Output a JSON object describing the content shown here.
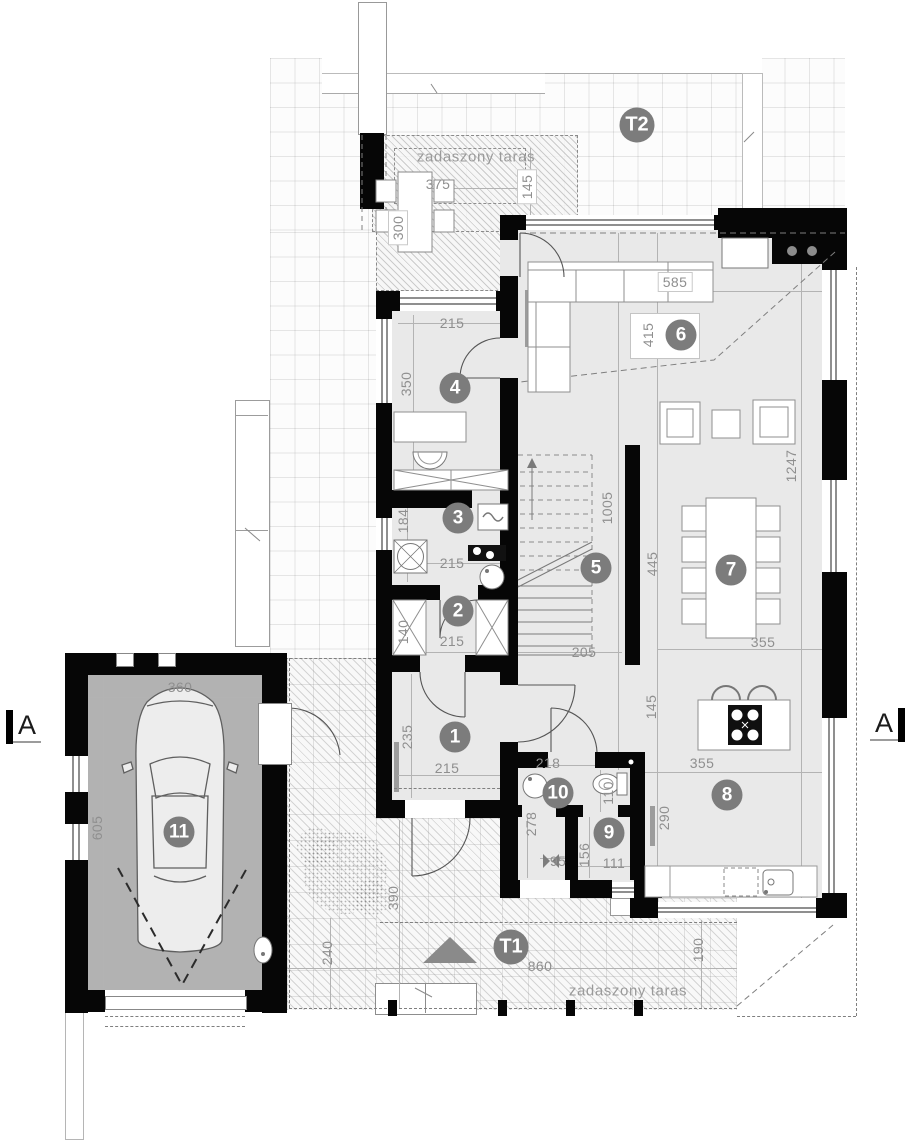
{
  "markers": {
    "t1": "T1",
    "t2": "T2",
    "section_a_left": "A",
    "section_a_right": "A"
  },
  "terrace_top": {
    "name": "zadaszony taras",
    "dims": {
      "width": "375",
      "depth": "145",
      "side": "300"
    }
  },
  "terrace_bottom": {
    "name": "zadaszony taras",
    "dims": {
      "width": "860",
      "left": "240",
      "walk": "390",
      "right": "190"
    }
  },
  "rooms": [
    {
      "no": "1",
      "dims": [
        "235",
        "215"
      ]
    },
    {
      "no": "2",
      "dims": [
        "140",
        "215"
      ]
    },
    {
      "no": "3",
      "dims": [
        "184",
        "215"
      ]
    },
    {
      "no": "4",
      "dims": [
        "215",
        "350"
      ]
    },
    {
      "no": "5",
      "dims": [
        "1005",
        "205"
      ]
    },
    {
      "no": "6",
      "dims": [
        "585",
        "415"
      ]
    },
    {
      "no": "7",
      "dims": [
        "355",
        "445",
        "1247"
      ]
    },
    {
      "no": "8",
      "dims": [
        "355",
        "145",
        "290"
      ]
    },
    {
      "no": "9",
      "dims": [
        "156",
        "111"
      ]
    },
    {
      "no": "10",
      "dims": [
        "218",
        "110",
        "278",
        "95"
      ]
    },
    {
      "no": "11",
      "dims": [
        "360",
        "605"
      ]
    }
  ]
}
